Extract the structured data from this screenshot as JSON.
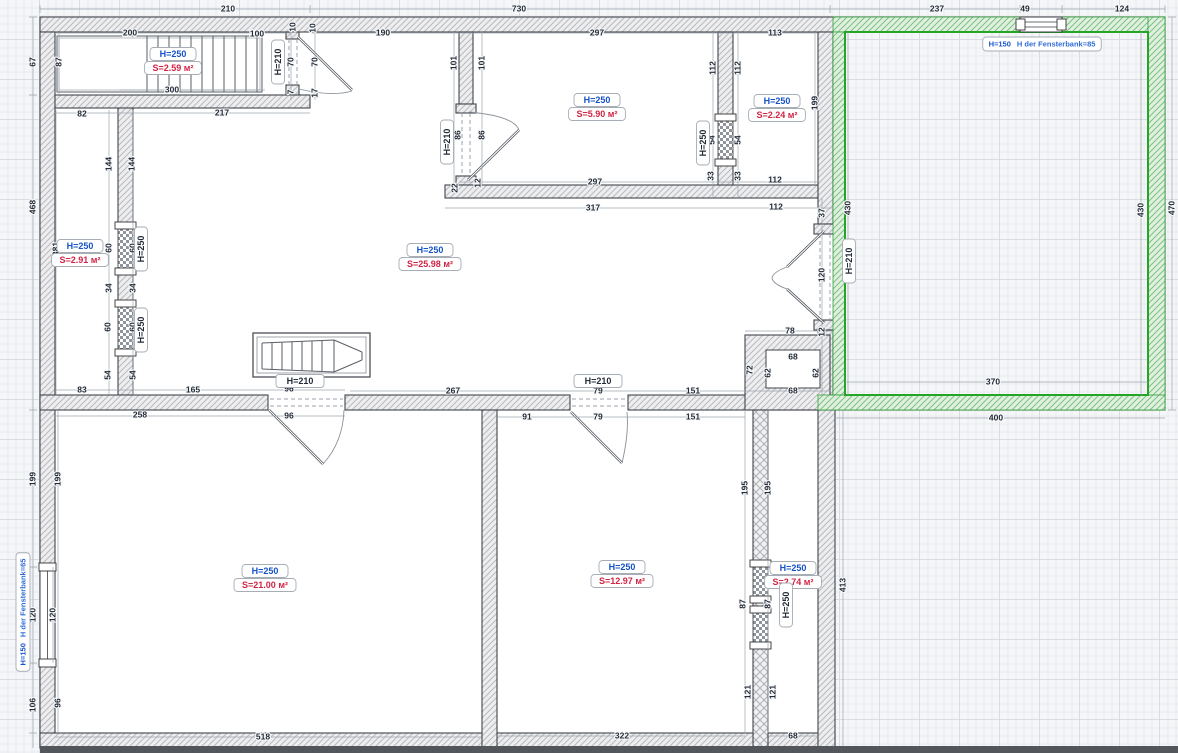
{
  "canvas": {
    "name": "floor-plan-editor-canvas"
  },
  "colors": {
    "h_label_blue": "#1553c8",
    "s_label_red": "#d02545",
    "selection_green": "#28a428",
    "sill_label_blue": "#2f6bd8",
    "dim_text": "#242c38",
    "wall_edge": "#41454c",
    "canvas_bg": "#f5f6f8"
  },
  "room_labels": [
    {
      "id": "staircase-room",
      "h": "H=250",
      "s": "S=2.59 м²",
      "x": 173,
      "y": 54
    },
    {
      "id": "top-middle-room",
      "h": "H=250",
      "s": "S=5.90 м²",
      "x": 597,
      "y": 100
    },
    {
      "id": "top-right-room",
      "h": "H=250",
      "s": "S=2.24 м²",
      "x": 777,
      "y": 101
    },
    {
      "id": "left-room",
      "h": "H=250",
      "s": "S=2.91 м²",
      "x": 80,
      "y": 246
    },
    {
      "id": "main-room",
      "h": "H=250",
      "s": "S=25.98 м²",
      "x": 430,
      "y": 250
    },
    {
      "id": "bottom-left-room",
      "h": "H=250",
      "s": "S=21.00 м²",
      "x": 265,
      "y": 571
    },
    {
      "id": "bottom-middle-room",
      "h": "H=250",
      "s": "S=12.97 м²",
      "x": 622,
      "y": 567
    },
    {
      "id": "bottom-right-room",
      "h": "H=250",
      "s": "S=2.74 м²",
      "x": 793,
      "y": 568
    }
  ],
  "door_labels": [
    {
      "t": "H=210",
      "x": 300,
      "y": 381
    },
    {
      "t": "H=210",
      "x": 598,
      "y": 381
    }
  ],
  "rotated_labels": [
    {
      "t": "H=210",
      "x": 278,
      "y": 62
    },
    {
      "t": "H=210",
      "x": 447,
      "y": 142
    },
    {
      "t": "H=250",
      "x": 703,
      "y": 143
    },
    {
      "t": "H=250",
      "x": 141,
      "y": 249
    },
    {
      "t": "H=250",
      "x": 141,
      "y": 330
    },
    {
      "t": "H=210",
      "x": 849,
      "y": 261
    },
    {
      "t": "H=250",
      "x": 786,
      "y": 605
    }
  ],
  "sill_labels": [
    {
      "h": "H=150",
      "rest": "H der Fensterbank=85",
      "x": 1042,
      "y": 44,
      "rot": 0
    },
    {
      "h": "H=150",
      "rest": "H der Fensterbank=65",
      "x": 23,
      "y": 612,
      "rot": -90
    }
  ],
  "dimensions": [
    {
      "x": 228,
      "y": 9,
      "t": "210"
    },
    {
      "x": 519,
      "y": 9,
      "t": "730"
    },
    {
      "x": 937,
      "y": 9,
      "t": "237"
    },
    {
      "x": 1025,
      "y": 9,
      "t": "49"
    },
    {
      "x": 1122,
      "y": 9,
      "t": "124"
    },
    {
      "x": 130,
      "y": 33,
      "t": "200"
    },
    {
      "x": 257,
      "y": 34,
      "t": "100"
    },
    {
      "x": 172,
      "y": 90,
      "t": "300"
    },
    {
      "x": 383,
      "y": 33,
      "t": "190"
    },
    {
      "x": 597,
      "y": 33,
      "t": "297"
    },
    {
      "x": 595,
      "y": 182,
      "t": "297"
    },
    {
      "x": 593,
      "y": 208,
      "t": "317"
    },
    {
      "x": 775,
      "y": 33,
      "t": "113"
    },
    {
      "x": 775,
      "y": 180,
      "t": "112"
    },
    {
      "x": 776,
      "y": 207,
      "t": "112"
    },
    {
      "x": 82,
      "y": 114,
      "t": "82"
    },
    {
      "x": 222,
      "y": 113,
      "t": "217"
    },
    {
      "x": 82,
      "y": 390,
      "t": "83"
    },
    {
      "x": 193,
      "y": 390,
      "t": "165"
    },
    {
      "x": 289,
      "y": 389,
      "t": "96"
    },
    {
      "x": 289,
      "y": 416,
      "t": "96"
    },
    {
      "x": 140,
      "y": 415,
      "t": "258"
    },
    {
      "x": 453,
      "y": 391,
      "t": "267"
    },
    {
      "x": 527,
      "y": 417,
      "t": "91"
    },
    {
      "x": 598,
      "y": 391,
      "t": "79"
    },
    {
      "x": 598,
      "y": 417,
      "t": "79"
    },
    {
      "x": 693,
      "y": 391,
      "t": "151"
    },
    {
      "x": 693,
      "y": 417,
      "t": "151"
    },
    {
      "x": 790,
      "y": 331,
      "t": "78"
    },
    {
      "x": 793,
      "y": 357,
      "t": "68"
    },
    {
      "x": 793,
      "y": 391,
      "t": "68"
    },
    {
      "x": 993,
      "y": 382,
      "t": "370"
    },
    {
      "x": 996,
      "y": 418,
      "t": "400"
    },
    {
      "x": 263,
      "y": 737,
      "t": "518"
    },
    {
      "x": 622,
      "y": 736,
      "t": "322"
    },
    {
      "x": 793,
      "y": 736,
      "t": "68"
    },
    {
      "x": 33,
      "y": 62,
      "t": "67",
      "r": 1
    },
    {
      "x": 59,
      "y": 62,
      "t": "87",
      "r": 1
    },
    {
      "x": 293,
      "y": 27,
      "t": "10",
      "r": 1
    },
    {
      "x": 313,
      "y": 28,
      "t": "10",
      "r": 1
    },
    {
      "x": 291,
      "y": 62,
      "t": "70",
      "r": 1
    },
    {
      "x": 315,
      "y": 62,
      "t": "70",
      "r": 1
    },
    {
      "x": 291,
      "y": 92,
      "t": "7",
      "r": 1
    },
    {
      "x": 315,
      "y": 93,
      "t": "17",
      "r": 1
    },
    {
      "x": 454,
      "y": 63,
      "t": "101",
      "r": 1
    },
    {
      "x": 482,
      "y": 63,
      "t": "101",
      "r": 1
    },
    {
      "x": 458,
      "y": 135,
      "t": "86",
      "r": 1
    },
    {
      "x": 482,
      "y": 135,
      "t": "86",
      "r": 1
    },
    {
      "x": 455,
      "y": 188,
      "t": "22",
      "r": 1
    },
    {
      "x": 478,
      "y": 183,
      "t": "12",
      "r": 1
    },
    {
      "x": 713,
      "y": 68,
      "t": "112",
      "r": 1
    },
    {
      "x": 738,
      "y": 68,
      "t": "112",
      "r": 1
    },
    {
      "x": 712,
      "y": 140,
      "t": "54",
      "r": 1
    },
    {
      "x": 738,
      "y": 140,
      "t": "54",
      "r": 1
    },
    {
      "x": 711,
      "y": 176,
      "t": "33",
      "r": 1
    },
    {
      "x": 738,
      "y": 176,
      "t": "33",
      "r": 1
    },
    {
      "x": 815,
      "y": 103,
      "t": "199",
      "r": 1
    },
    {
      "x": 822,
      "y": 213,
      "t": "37",
      "r": 1
    },
    {
      "x": 822,
      "y": 275,
      "t": "120",
      "r": 1
    },
    {
      "x": 822,
      "y": 332,
      "t": "12",
      "r": 1
    },
    {
      "x": 848,
      "y": 208,
      "t": "430",
      "r": 1
    },
    {
      "x": 1141,
      "y": 210,
      "t": "430",
      "r": 1
    },
    {
      "x": 1172,
      "y": 208,
      "t": "470",
      "r": 1
    },
    {
      "x": 33,
      "y": 207,
      "t": "468",
      "r": 1
    },
    {
      "x": 56,
      "y": 249,
      "t": "381",
      "r": 1
    },
    {
      "x": 109,
      "y": 164,
      "t": "144",
      "r": 1
    },
    {
      "x": 132,
      "y": 164,
      "t": "144",
      "r": 1
    },
    {
      "x": 109,
      "y": 248,
      "t": "60",
      "r": 1
    },
    {
      "x": 133,
      "y": 248,
      "t": "60",
      "r": 1
    },
    {
      "x": 109,
      "y": 288,
      "t": "34",
      "r": 1
    },
    {
      "x": 133,
      "y": 288,
      "t": "34",
      "r": 1
    },
    {
      "x": 108,
      "y": 327,
      "t": "60",
      "r": 1
    },
    {
      "x": 133,
      "y": 327,
      "t": "60",
      "r": 1
    },
    {
      "x": 108,
      "y": 375,
      "t": "54",
      "r": 1
    },
    {
      "x": 133,
      "y": 375,
      "t": "54",
      "r": 1
    },
    {
      "x": 750,
      "y": 370,
      "t": "72",
      "r": 1
    },
    {
      "x": 768,
      "y": 373,
      "t": "62",
      "r": 1
    },
    {
      "x": 816,
      "y": 373,
      "t": "62",
      "r": 1
    },
    {
      "x": 33,
      "y": 479,
      "t": "199",
      "r": 1
    },
    {
      "x": 58,
      "y": 479,
      "t": "199",
      "r": 1
    },
    {
      "x": 33,
      "y": 615,
      "t": "120",
      "r": 1
    },
    {
      "x": 53,
      "y": 615,
      "t": "120",
      "r": 1
    },
    {
      "x": 33,
      "y": 705,
      "t": "106",
      "r": 1
    },
    {
      "x": 58,
      "y": 703,
      "t": "96",
      "r": 1
    },
    {
      "x": 745,
      "y": 488,
      "t": "195",
      "r": 1
    },
    {
      "x": 768,
      "y": 488,
      "t": "195",
      "r": 1
    },
    {
      "x": 743,
      "y": 604,
      "t": "87",
      "r": 1
    },
    {
      "x": 768,
      "y": 604,
      "t": "87",
      "r": 1
    },
    {
      "x": 801,
      "y": 576,
      "t": "403",
      "r": 1
    },
    {
      "x": 843,
      "y": 585,
      "t": "413",
      "r": 1
    },
    {
      "x": 748,
      "y": 692,
      "t": "121",
      "r": 1
    },
    {
      "x": 773,
      "y": 692,
      "t": "121",
      "r": 1
    }
  ]
}
